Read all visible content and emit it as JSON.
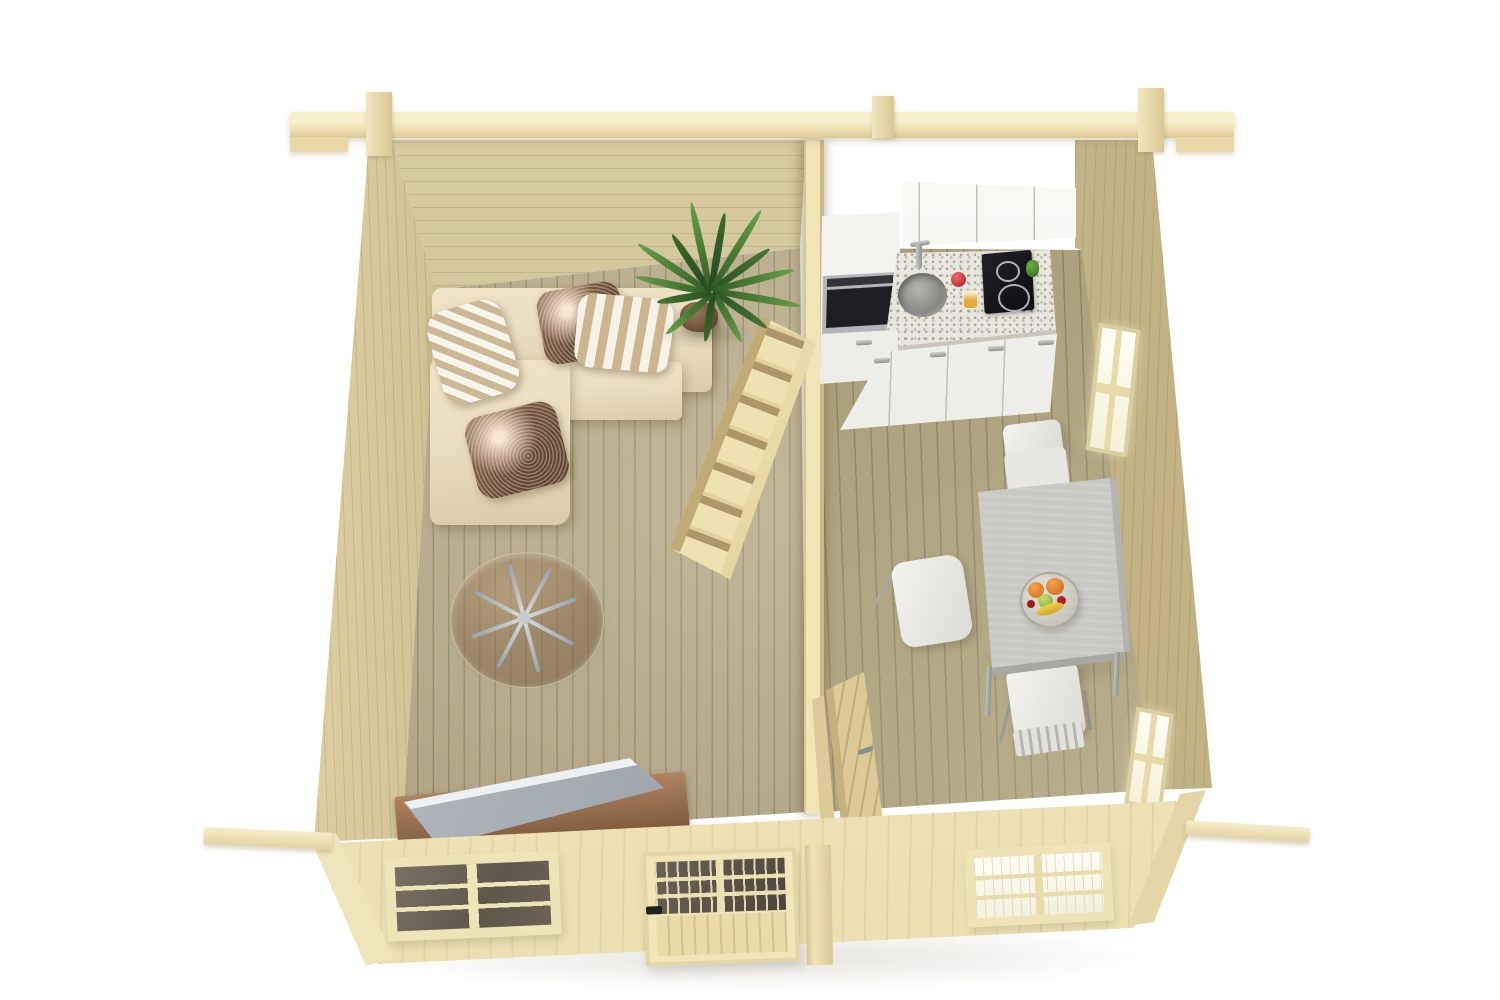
{
  "meta": {
    "type": "3d-render",
    "subject": "top-down cutaway view of a log cabin interior with living room and kitchen-dining room",
    "background": "#ffffff"
  },
  "palette": {
    "bg": "#ffffff",
    "beam": "#ead9a9",
    "exterior": "#ecdfb2",
    "wall_back": "#d9cda3",
    "wall_side": "#cdbf93",
    "wall_right": "#c9ba8c",
    "partition": "#f1e5b7",
    "floor_living": "#b9ad8d",
    "floor_kitchen": "#aea27f",
    "stairs": "#efe2b1",
    "sofa": "#ecdfc2",
    "pillow_light": "#f8f5ec",
    "pillow_tan": "#cdb895",
    "pillow_sequin": "#5e4534",
    "glass_brown": "rgba(115,88,58,0.48)",
    "plant": "#4e8038",
    "pot": "#5f4530",
    "tv": "#9aa1a8",
    "tv_stand": "#7d5a3e",
    "cabinet": "#eaeae5",
    "counter": "#ddd9cf",
    "steel": "#8f9497",
    "sink": "#7f7f7b",
    "cooktop": "#0d0d11",
    "cup_red": "#a01c26",
    "juice": "#e6aa3c",
    "pepper": "#2f6b22",
    "table": "#c3c3bf",
    "chair": "#dcdad5",
    "orange": "#d2691e",
    "apple": "#7ca832",
    "banana": "#d4a82a",
    "door_wood": "#d2bf8a",
    "pane_dark": "#5f564b",
    "pane_bright": "#f4f0dd"
  },
  "rooms": {
    "living_room": {
      "label": "living room",
      "objects": [
        "l-shaped-sofa",
        "pillows x4 (2 striped, 2 metallic-sequin)",
        "round-glass-coffee-table",
        "palm-plant",
        "staircase",
        "tv-on-wooden-stand"
      ]
    },
    "kitchen_dining": {
      "label": "kitchen and dining room",
      "objects": [
        "upper-cabinets x3 doors",
        "tall-cabinet-with-oven",
        "granite-countertop",
        "round-sink with faucet",
        "2-burner-cooktop",
        "lower-cabinets",
        "dining-table",
        "chairs x3",
        "fruit-bowl",
        "open-interior-door"
      ]
    }
  },
  "counts": {
    "pillows": 4,
    "dining_chairs": 3,
    "cooktop_burners": 2,
    "front_windows": 2,
    "right_wall_windows": 2,
    "entrance_doors": 1,
    "interior_doors": 1,
    "stair_steps": 6
  },
  "fruit_bowl_contents": [
    "orange",
    "orange",
    "green apple",
    "cherries",
    "banana"
  ]
}
